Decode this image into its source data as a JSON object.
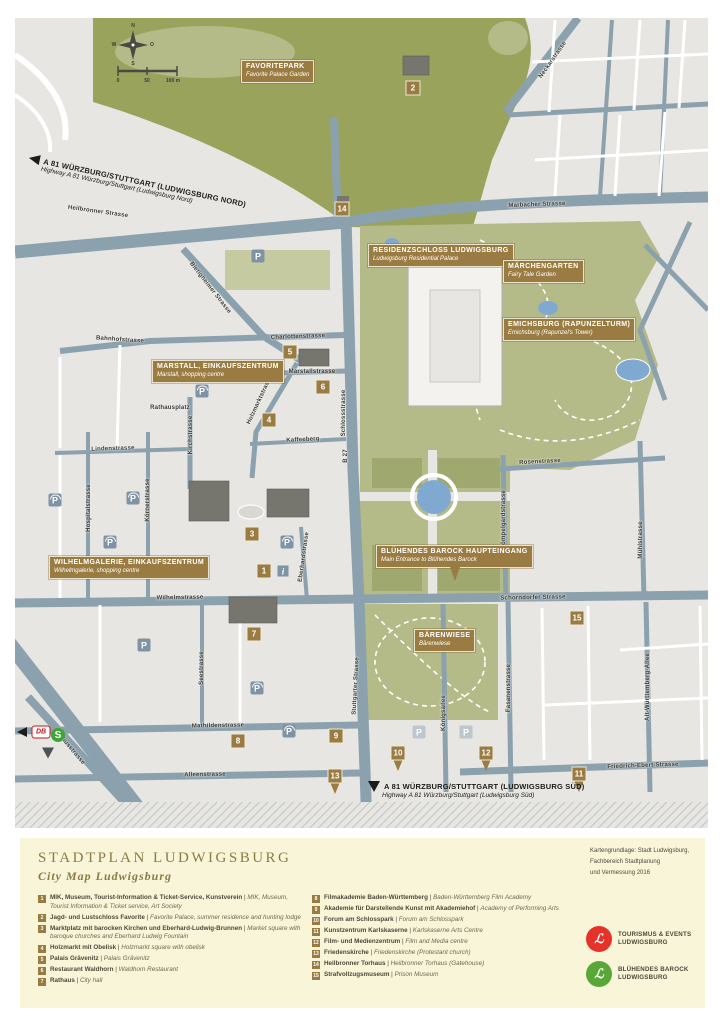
{
  "palette": {
    "map_background": "#e7e6e2",
    "road_blue_grey": "#8ba1ad",
    "park_dark_green": "#9aa35c",
    "park_light_green": "#b5bb88",
    "park_pale_green": "#c6caa0",
    "water_blue": "#7fa9d1",
    "label_brown": "#9a7c42",
    "legend_cream": "#f9f5d8",
    "title_olive": "#8b7b45",
    "logo_red": "#e63229",
    "logo_green": "#58a838"
  },
  "map": {
    "compass": {
      "n": "N",
      "e": "O",
      "s": "S",
      "w": "W"
    },
    "scale_bar": {
      "labels": [
        "0",
        "50",
        "100 m"
      ]
    },
    "icons": {
      "parking_glyph": "P",
      "info_glyph": "i",
      "db_label": "DB",
      "sbahn_glyph": "S"
    },
    "highways": [
      {
        "id": "north",
        "line1": "A 81 WÜRZBURG/STUTTGART (LUDWIGSBURG NORD)",
        "line2": "Highway A 81 Würzburg/Stuttgart (Ludwigsburg Nord)",
        "x": 30,
        "y": 153,
        "rot": 12,
        "arrow": "left"
      },
      {
        "id": "south",
        "line1": "A 81 WÜRZBURG/STUTTGART (LUDWIGSBURG SÜD)",
        "line2": "Highway A 81 Würzburg/Stuttgart (Ludwigsburg Süd)",
        "x": 368,
        "y": 781,
        "rot": 0,
        "arrow": "down"
      }
    ],
    "poi_boxes": [
      {
        "id": "favoritepark",
        "line1": "FAVORITEPARK",
        "line2": "Favorite Palace Garden",
        "x": 241,
        "y": 60
      },
      {
        "id": "residenzschloss",
        "line1": "RESIDENZSCHLOSS LUDWIGSBURG",
        "line2": "Ludwigsburg Residential Palace",
        "x": 368,
        "y": 244
      },
      {
        "id": "maerchengarten",
        "line1": "MÄRCHENGARTEN",
        "line2": "Fairy Tale Garden",
        "x": 503,
        "y": 260
      },
      {
        "id": "emichsburg",
        "line1": "EMICHSBURG (RAPUNZELTURM)",
        "line2": "Emichsburg (Rapunzel's Tower)",
        "x": 503,
        "y": 318
      },
      {
        "id": "marstall",
        "line1": "MARSTALL, EINKAUFSZENTRUM",
        "line2": "Marstall, shopping centre",
        "x": 152,
        "y": 360
      },
      {
        "id": "wilhelmgalerie",
        "line1": "WILHELMGALERIE, EINKAUFSZENTRUM",
        "line2": "Wilhelmgalerie, shopping centre",
        "x": 49,
        "y": 556
      },
      {
        "id": "bluehendes-barock-haupteingang",
        "line1": "BLÜHENDES BAROCK HAUPTEINGANG",
        "line2": "Main Entrance to Blühendes Barock",
        "x": 376,
        "y": 545,
        "pin": true
      },
      {
        "id": "baerenwiese",
        "line1": "BÄRENWIESE",
        "line2": "Bärenwiese",
        "x": 414,
        "y": 629
      }
    ],
    "streets": [
      {
        "name": "Heilbronner Strasse",
        "x": 98,
        "y": 212,
        "rot": 8
      },
      {
        "name": "Marbacher Strasse",
        "x": 537,
        "y": 205,
        "rot": -2
      },
      {
        "name": "Neckarstrasse",
        "x": 553,
        "y": 60,
        "rot": -55
      },
      {
        "name": "Bietigheimer Strasse",
        "x": 210,
        "y": 288,
        "rot": 52
      },
      {
        "name": "Bahnhofstrasse",
        "x": 120,
        "y": 340,
        "rot": 4
      },
      {
        "name": "Charlottenstrasse",
        "x": 298,
        "y": 337,
        "rot": -2
      },
      {
        "name": "Marstallstrasse",
        "x": 312,
        "y": 372,
        "rot": 0
      },
      {
        "name": "Rathausplatz",
        "x": 170,
        "y": 408,
        "rot": 0
      },
      {
        "name": "Kirchstrasse",
        "x": 191,
        "y": 435,
        "rot": -90
      },
      {
        "name": "Kaffeeberg",
        "x": 303,
        "y": 440,
        "rot": -3
      },
      {
        "name": "Lindenstrasse",
        "x": 113,
        "y": 449,
        "rot": -2
      },
      {
        "name": "Schlossstrasse",
        "x": 344,
        "y": 413,
        "rot": -90
      },
      {
        "name": "B 27",
        "x": 346,
        "y": 456,
        "rot": -90
      },
      {
        "name": "Rosenstrasse",
        "x": 540,
        "y": 462,
        "rot": -3
      },
      {
        "name": "Mömpelgardstrasse",
        "x": 504,
        "y": 520,
        "rot": -90
      },
      {
        "name": "Mühlstrasse",
        "x": 641,
        "y": 540,
        "rot": -90
      },
      {
        "name": "Holzmarktstrasse",
        "x": 260,
        "y": 400,
        "rot": -65
      },
      {
        "name": "Wilhelmstrasse",
        "x": 180,
        "y": 598,
        "rot": -1
      },
      {
        "name": "Schorndorfer Strasse",
        "x": 533,
        "y": 598,
        "rot": -1
      },
      {
        "name": "Hospitalstrasse",
        "x": 89,
        "y": 508,
        "rot": -90
      },
      {
        "name": "Körnerstrasse",
        "x": 148,
        "y": 500,
        "rot": -90
      },
      {
        "name": "Eberhardstrasse",
        "x": 304,
        "y": 557,
        "rot": -82
      },
      {
        "name": "Seestrasse",
        "x": 202,
        "y": 668,
        "rot": -90
      },
      {
        "name": "Stuttgarter Strasse",
        "x": 356,
        "y": 686,
        "rot": -87
      },
      {
        "name": "Mathildenstrasse",
        "x": 218,
        "y": 726,
        "rot": -1
      },
      {
        "name": "Alleenstrasse",
        "x": 205,
        "y": 775,
        "rot": -1
      },
      {
        "name": "Myliusstrasse",
        "x": 70,
        "y": 748,
        "rot": 50
      },
      {
        "name": "Königsallee",
        "x": 444,
        "y": 713,
        "rot": -90
      },
      {
        "name": "Fasanenstrasse",
        "x": 509,
        "y": 688,
        "rot": -90
      },
      {
        "name": "Friedrich-Ebert-Strasse",
        "x": 643,
        "y": 766,
        "rot": -2
      },
      {
        "name": "Alt-Württemberg-Allee",
        "x": 648,
        "y": 687,
        "rot": -90
      }
    ],
    "markers": [
      {
        "n": "2",
        "x": 413,
        "y": 88
      },
      {
        "n": "14",
        "x": 342,
        "y": 209
      },
      {
        "n": "5",
        "x": 290,
        "y": 352
      },
      {
        "n": "6",
        "x": 323,
        "y": 387
      },
      {
        "n": "4",
        "x": 269,
        "y": 420
      },
      {
        "n": "3",
        "x": 252,
        "y": 534
      },
      {
        "n": "1",
        "x": 264,
        "y": 571
      },
      {
        "n": "7",
        "x": 254,
        "y": 634
      },
      {
        "n": "15",
        "x": 577,
        "y": 618
      },
      {
        "n": "8",
        "x": 238,
        "y": 741
      },
      {
        "n": "9",
        "x": 336,
        "y": 736
      },
      {
        "n": "13",
        "x": 335,
        "y": 776,
        "pin": true
      },
      {
        "n": "10",
        "x": 398,
        "y": 753,
        "pin": true
      },
      {
        "n": "12",
        "x": 486,
        "y": 753,
        "pin": true
      },
      {
        "n": "11",
        "x": 579,
        "y": 774,
        "pin": true
      }
    ],
    "parkings": [
      {
        "x": 258,
        "y": 256
      },
      {
        "x": 202,
        "y": 391,
        "covered": true
      },
      {
        "x": 133,
        "y": 498,
        "covered": true
      },
      {
        "x": 55,
        "y": 500,
        "covered": true
      },
      {
        "x": 110,
        "y": 542,
        "covered": true
      },
      {
        "x": 287,
        "y": 542,
        "covered": true
      },
      {
        "x": 144,
        "y": 645
      },
      {
        "x": 257,
        "y": 688,
        "covered": true
      },
      {
        "x": 289,
        "y": 731,
        "covered": true
      },
      {
        "x": 419,
        "y": 732,
        "light": true
      },
      {
        "x": 466,
        "y": 732,
        "light": true
      }
    ]
  },
  "legend": {
    "title": "STADTPLAN LUDWIGSBURG",
    "subtitle": "City Map Ludwigsburg",
    "credits": [
      "Kartengrundlage: Stadt Ludwigsburg,",
      "Fachbereich Stadtplanung",
      "und Vermessung 2016"
    ],
    "separator": " | ",
    "items_left": [
      {
        "n": "1",
        "de": "MIK, Museum, Tourist-Information & Ticket-Service, Kunstverein",
        "en": "MIK, Museum, Tourist Information & Ticket service, Art Society"
      },
      {
        "n": "2",
        "de": "Jagd- und Lustschloss Favorite",
        "en": "Favorite Palace, summer residence and hunting lodge"
      },
      {
        "n": "3",
        "de": "Marktplatz mit barocken Kirchen und Eberhard-Ludwig-Brunnen",
        "en": "Market square with baroque churches and Eberhard Ludwig Fountain"
      },
      {
        "n": "4",
        "de": "Holzmarkt mit Obelisk",
        "en": "Holzmarkt square with obelisk"
      },
      {
        "n": "5",
        "de": "Palais Grävenitz",
        "en": "Palais Grävenitz"
      },
      {
        "n": "6",
        "de": "Restaurant Waldhorn",
        "en": "Waldhorn Restaurant"
      },
      {
        "n": "7",
        "de": "Rathaus",
        "en": "City hall"
      }
    ],
    "items_right": [
      {
        "n": "8",
        "de": "Filmakademie Baden-Württemberg",
        "en": "Baden-Württemberg Film Academy"
      },
      {
        "n": "9",
        "de": "Akademie für Darstellende Kunst mit Akademiehof",
        "en": "Academy of Performing Arts"
      },
      {
        "n": "10",
        "de": "Forum am Schlosspark",
        "en": "Forum am Schlosspark"
      },
      {
        "n": "11",
        "de": "Kunstzentrum Karlskaserne",
        "en": "Karlskaserne Arts Centre"
      },
      {
        "n": "12",
        "de": "Film- und Medienzentrum",
        "en": "Film and Media centre"
      },
      {
        "n": "13",
        "de": "Friedenskirche",
        "en": "Friedenskirche (Protestant church)"
      },
      {
        "n": "14",
        "de": "Heilbronner Torhaus",
        "en": "Heilbronner Torhaus (Gatehouse)"
      },
      {
        "n": "15",
        "de": "Strafvollzugsmuseum",
        "en": "Prison Museum"
      }
    ],
    "logos": [
      {
        "glyph": "ℒ",
        "line1": "TOURISMUS & EVENTS",
        "line2": "LUDWIGSBURG",
        "color": "#e63229"
      },
      {
        "glyph": "ℒ",
        "line1": "BLÜHENDES BAROCK",
        "line2": "LUDWIGSBURG",
        "color": "#58a838"
      }
    ]
  }
}
